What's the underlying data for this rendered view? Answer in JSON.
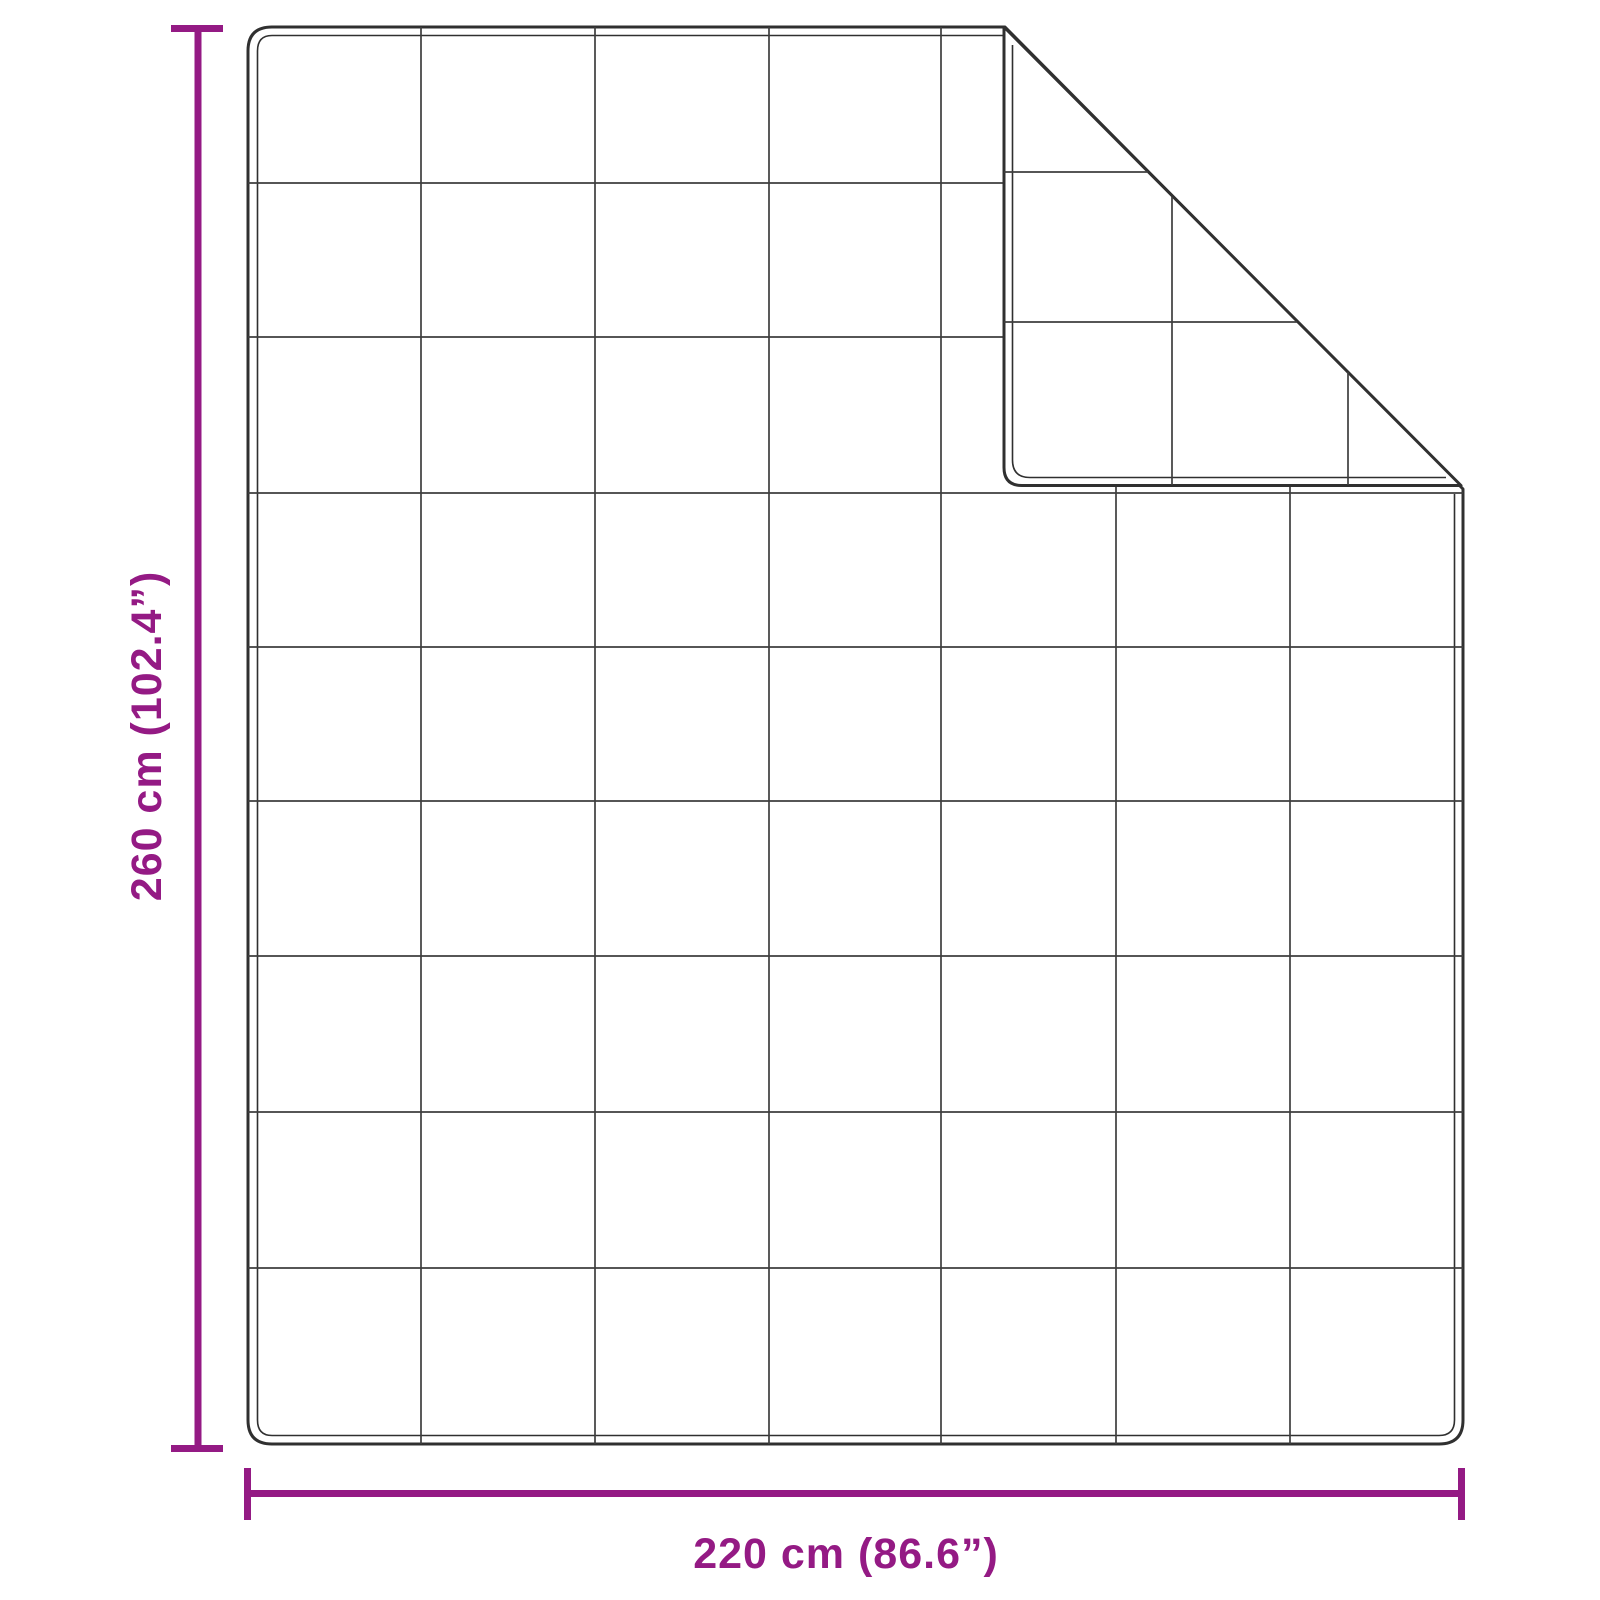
{
  "diagram": {
    "figure": "quilted-blanket-with-folded-corner",
    "grid": {
      "columns": 7,
      "rows": 9
    },
    "dimensions": {
      "height_label": "260 cm (102.4”)",
      "width_label": "220 cm (86.6”)"
    },
    "colors": {
      "dimension": "#941A84",
      "outline": "#303030",
      "grid": "#3E3E3E",
      "background": "#FFFFFF"
    }
  }
}
